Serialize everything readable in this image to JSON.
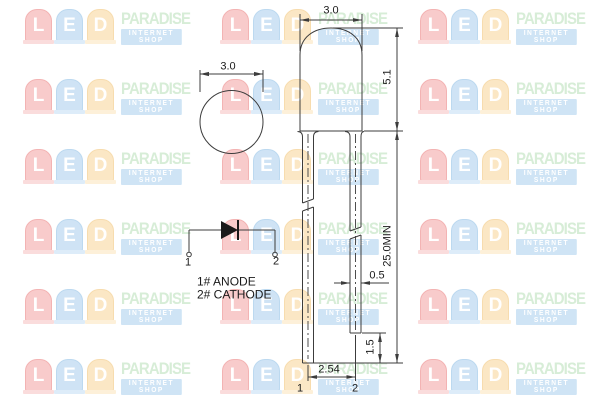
{
  "watermark": {
    "letters": [
      {
        "char": "L",
        "bg": "#f8cbcb",
        "border": "#f3b3b3",
        "flange": "#fadcdc"
      },
      {
        "char": "E",
        "bg": "#cfe3f5",
        "border": "#bcd9f0",
        "flange": "#ddecf9"
      },
      {
        "char": "D",
        "bg": "#fbe7c5",
        "border": "#f7dcae",
        "flange": "#fdf0d9"
      }
    ],
    "brand": "PARADISE",
    "tagline": "INTERNET SHOP",
    "brand_color": "#d7edd7",
    "tagline_bg": "#cfe4f5",
    "letter_color": "#ffffff"
  },
  "drawing": {
    "line_color": "#3c3c3c",
    "text_color": "#1a1a1a",
    "top_view": {
      "diameter_label": "3.0"
    },
    "side_view": {
      "width_label": "3.0",
      "head_height_label": "5.1",
      "lead_length_label": "25.0MIN",
      "lead_width_label": "0.5",
      "lead_offset_label": "1.5",
      "pitch_label": "2.54",
      "pin1_label": "1",
      "pin2_label": "2"
    },
    "schematic": {
      "pin1_label": "1",
      "pin2_label": "2",
      "anode_label": "1# ANODE",
      "cathode_label": "2# CATHODE"
    }
  }
}
